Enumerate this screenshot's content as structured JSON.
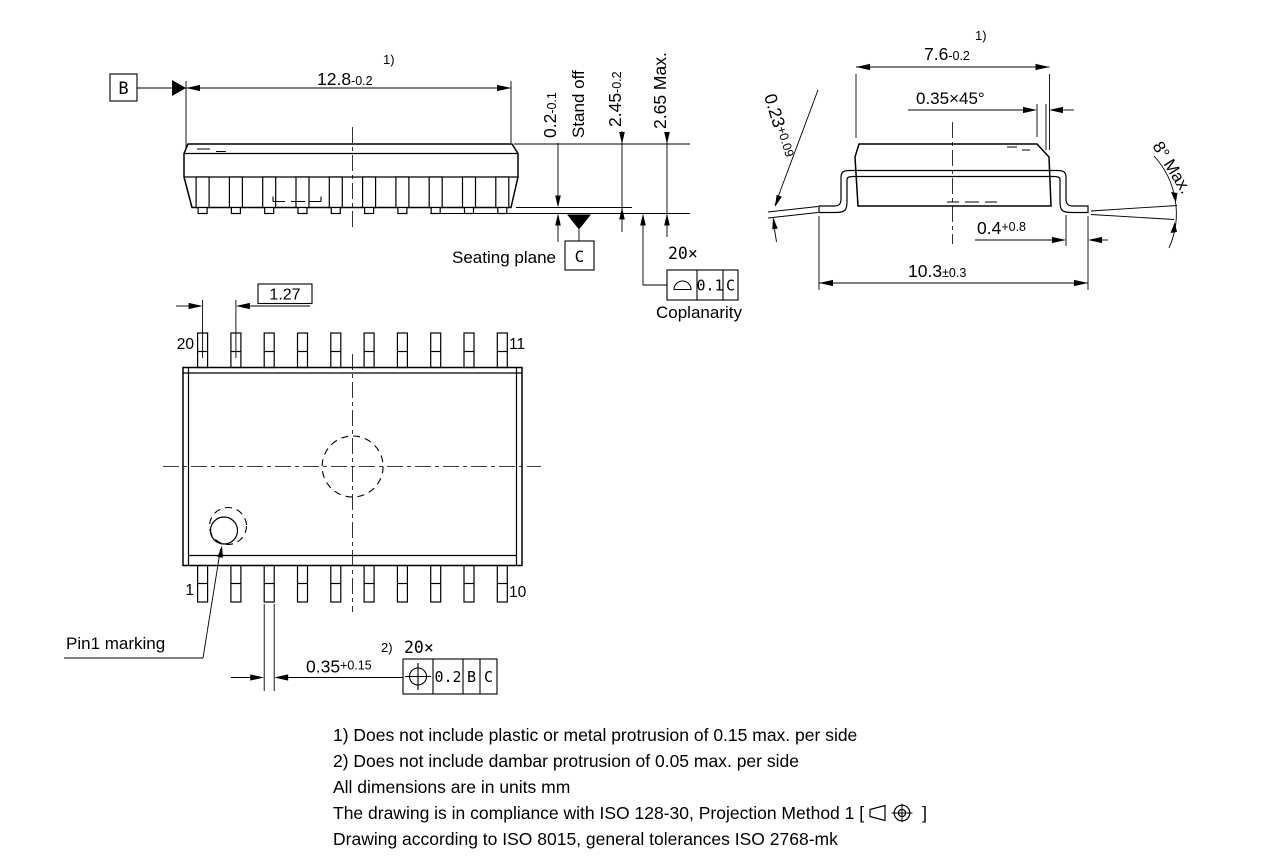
{
  "side_view": {
    "datum_b": "B",
    "length": {
      "value": "12.8",
      "tol": "-0.2",
      "ref": "1)"
    },
    "standoff": {
      "value": "0.2",
      "tol": "-0.1"
    },
    "standoff_label": "Stand off",
    "body_height": {
      "value": "2.45",
      "tol": "-0.2"
    },
    "overall_height": "2.65 Max.",
    "seating_plane_label": "Seating plane",
    "datum_c": "C",
    "lead_count": "20×",
    "coplanarity": {
      "tol": "0.1",
      "datum": "C",
      "label": "Coplanarity"
    }
  },
  "end_view": {
    "width": {
      "value": "7.6",
      "tol": "-0.2",
      "ref": "1)"
    },
    "chamfer": "0.35×45°",
    "lead_thickness": {
      "value": "0.23",
      "tol": "+0.09"
    },
    "foot_length": {
      "value": "0.4",
      "tol": "+0.8"
    },
    "lead_angle": "8° Max.",
    "overall_span": {
      "value": "10.3",
      "tol": "±0.3"
    }
  },
  "plan_view": {
    "pitch": "1.27",
    "pin_top_left": "20",
    "pin_top_right": "11",
    "pin_bottom_left": "1",
    "pin_bottom_right": "10",
    "pin1_label": "Pin1 marking",
    "lead_width": {
      "value": "0.35",
      "tol": "+0.15",
      "ref": "2)",
      "count": "20×"
    },
    "position": {
      "tol": "0.2",
      "datum1": "B",
      "datum2": "C"
    }
  },
  "notes": {
    "line1": "1) Does not include plastic or metal protrusion of 0.15 max. per side",
    "line2": "2) Does not include dambar protrusion of 0.05 max. per side",
    "line3": "All dimensions are in units mm",
    "line4_prefix": "The drawing is in compliance with ISO 128-30, Projection Method 1 [",
    "line4_suffix": "]",
    "line5": "Drawing according to ISO 8015, general tolerances ISO 2768-mk"
  }
}
